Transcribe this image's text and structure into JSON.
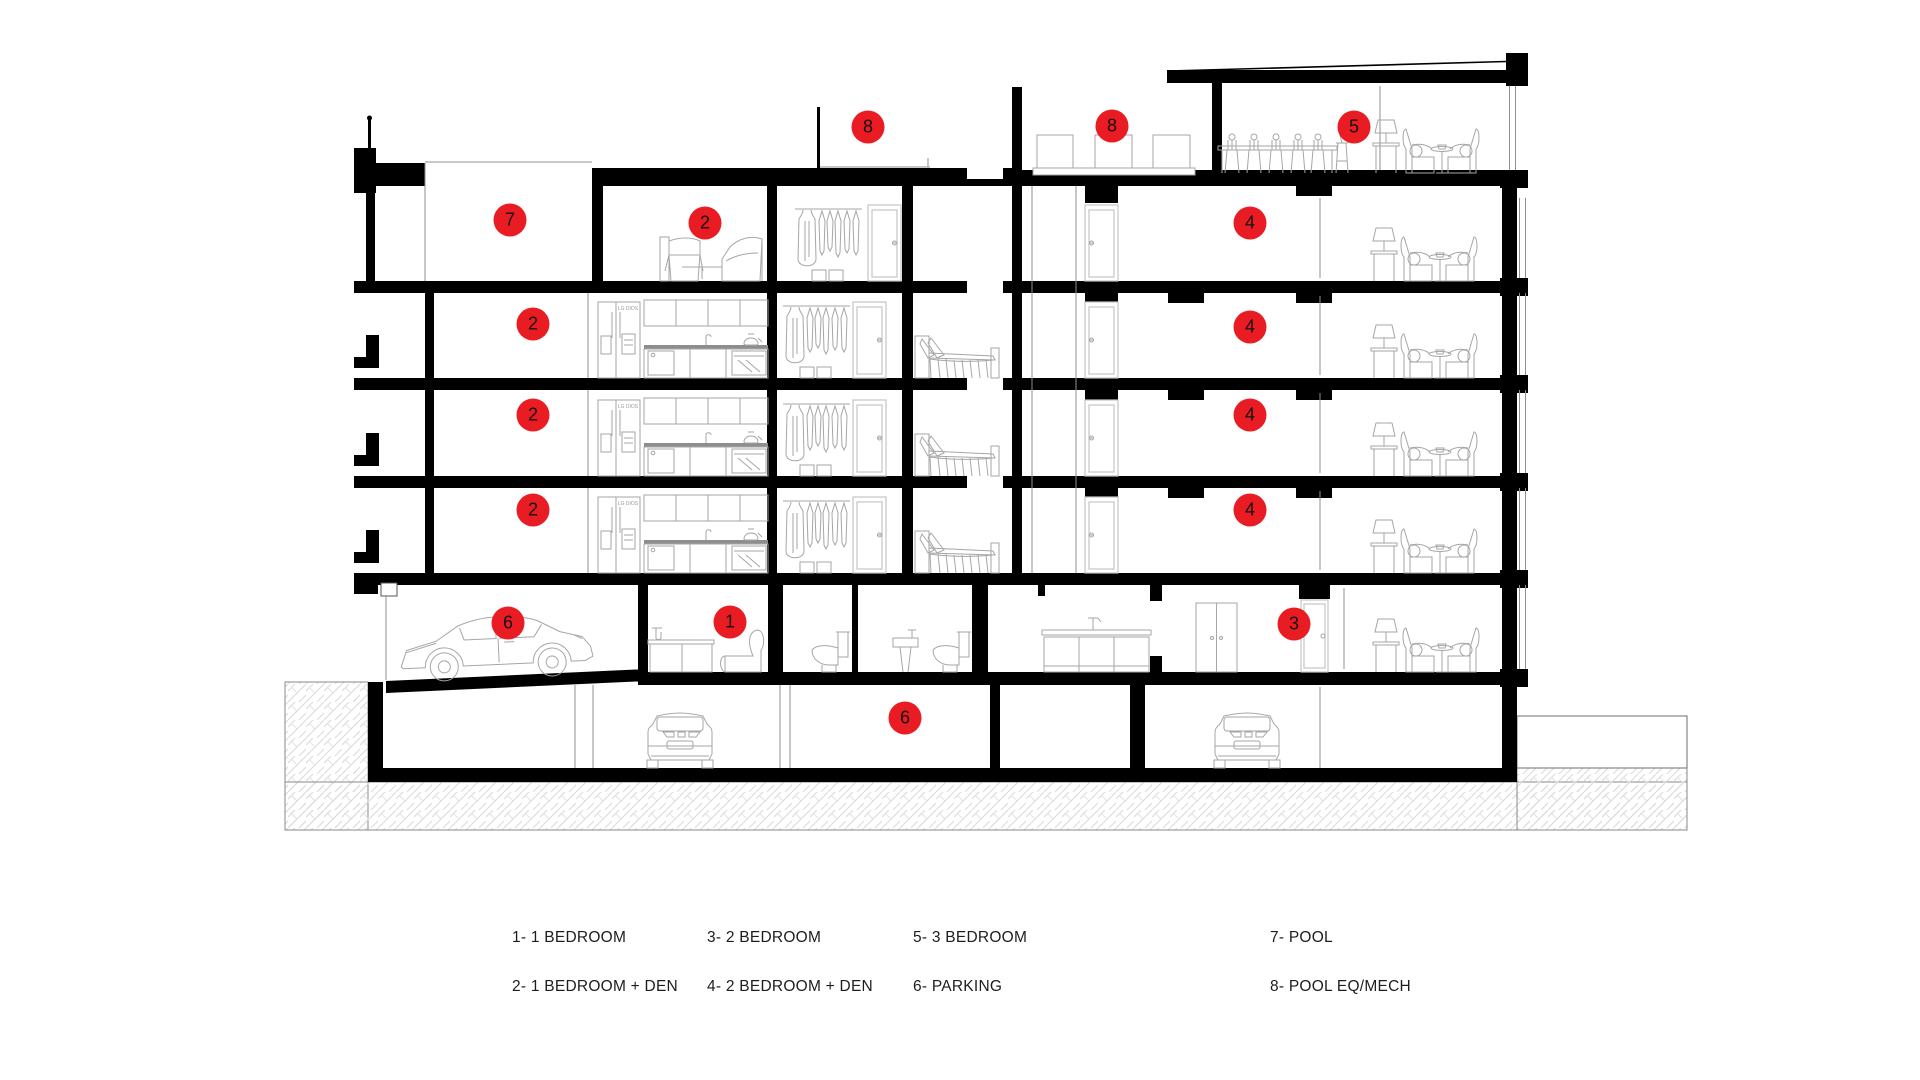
{
  "page": {
    "background": "#ffffff"
  },
  "drawing": {
    "type": "architectural-building-section",
    "marker_color": "#ea1c23",
    "fridge_label": "LG DIOS",
    "markers": [
      {
        "label": "7",
        "x": 510,
        "y": 220
      },
      {
        "label": "2",
        "x": 705,
        "y": 223
      },
      {
        "label": "8",
        "x": 868,
        "y": 127
      },
      {
        "label": "8",
        "x": 1112,
        "y": 126
      },
      {
        "label": "5",
        "x": 1354,
        "y": 127
      },
      {
        "label": "4",
        "x": 1250,
        "y": 223
      },
      {
        "label": "2",
        "x": 533,
        "y": 324
      },
      {
        "label": "4",
        "x": 1250,
        "y": 327
      },
      {
        "label": "2",
        "x": 533,
        "y": 415
      },
      {
        "label": "4",
        "x": 1250,
        "y": 415
      },
      {
        "label": "2",
        "x": 533,
        "y": 510
      },
      {
        "label": "4",
        "x": 1250,
        "y": 510
      },
      {
        "label": "6",
        "x": 508,
        "y": 623
      },
      {
        "label": "1",
        "x": 730,
        "y": 622
      },
      {
        "label": "3",
        "x": 1294,
        "y": 624
      },
      {
        "label": "6",
        "x": 905,
        "y": 718
      }
    ]
  },
  "legend": {
    "items": [
      {
        "text": "1- 1 BEDROOM"
      },
      {
        "text": "2- 1 BEDROOM + DEN"
      },
      {
        "text": "3- 2 BEDROOM"
      },
      {
        "text": "4- 2 BEDROOM + DEN"
      },
      {
        "text": "5- 3 BEDROOM"
      },
      {
        "text": "6- PARKING"
      },
      {
        "text": "7- POOL"
      },
      {
        "text": "8- POOL EQ/MECH"
      }
    ]
  }
}
